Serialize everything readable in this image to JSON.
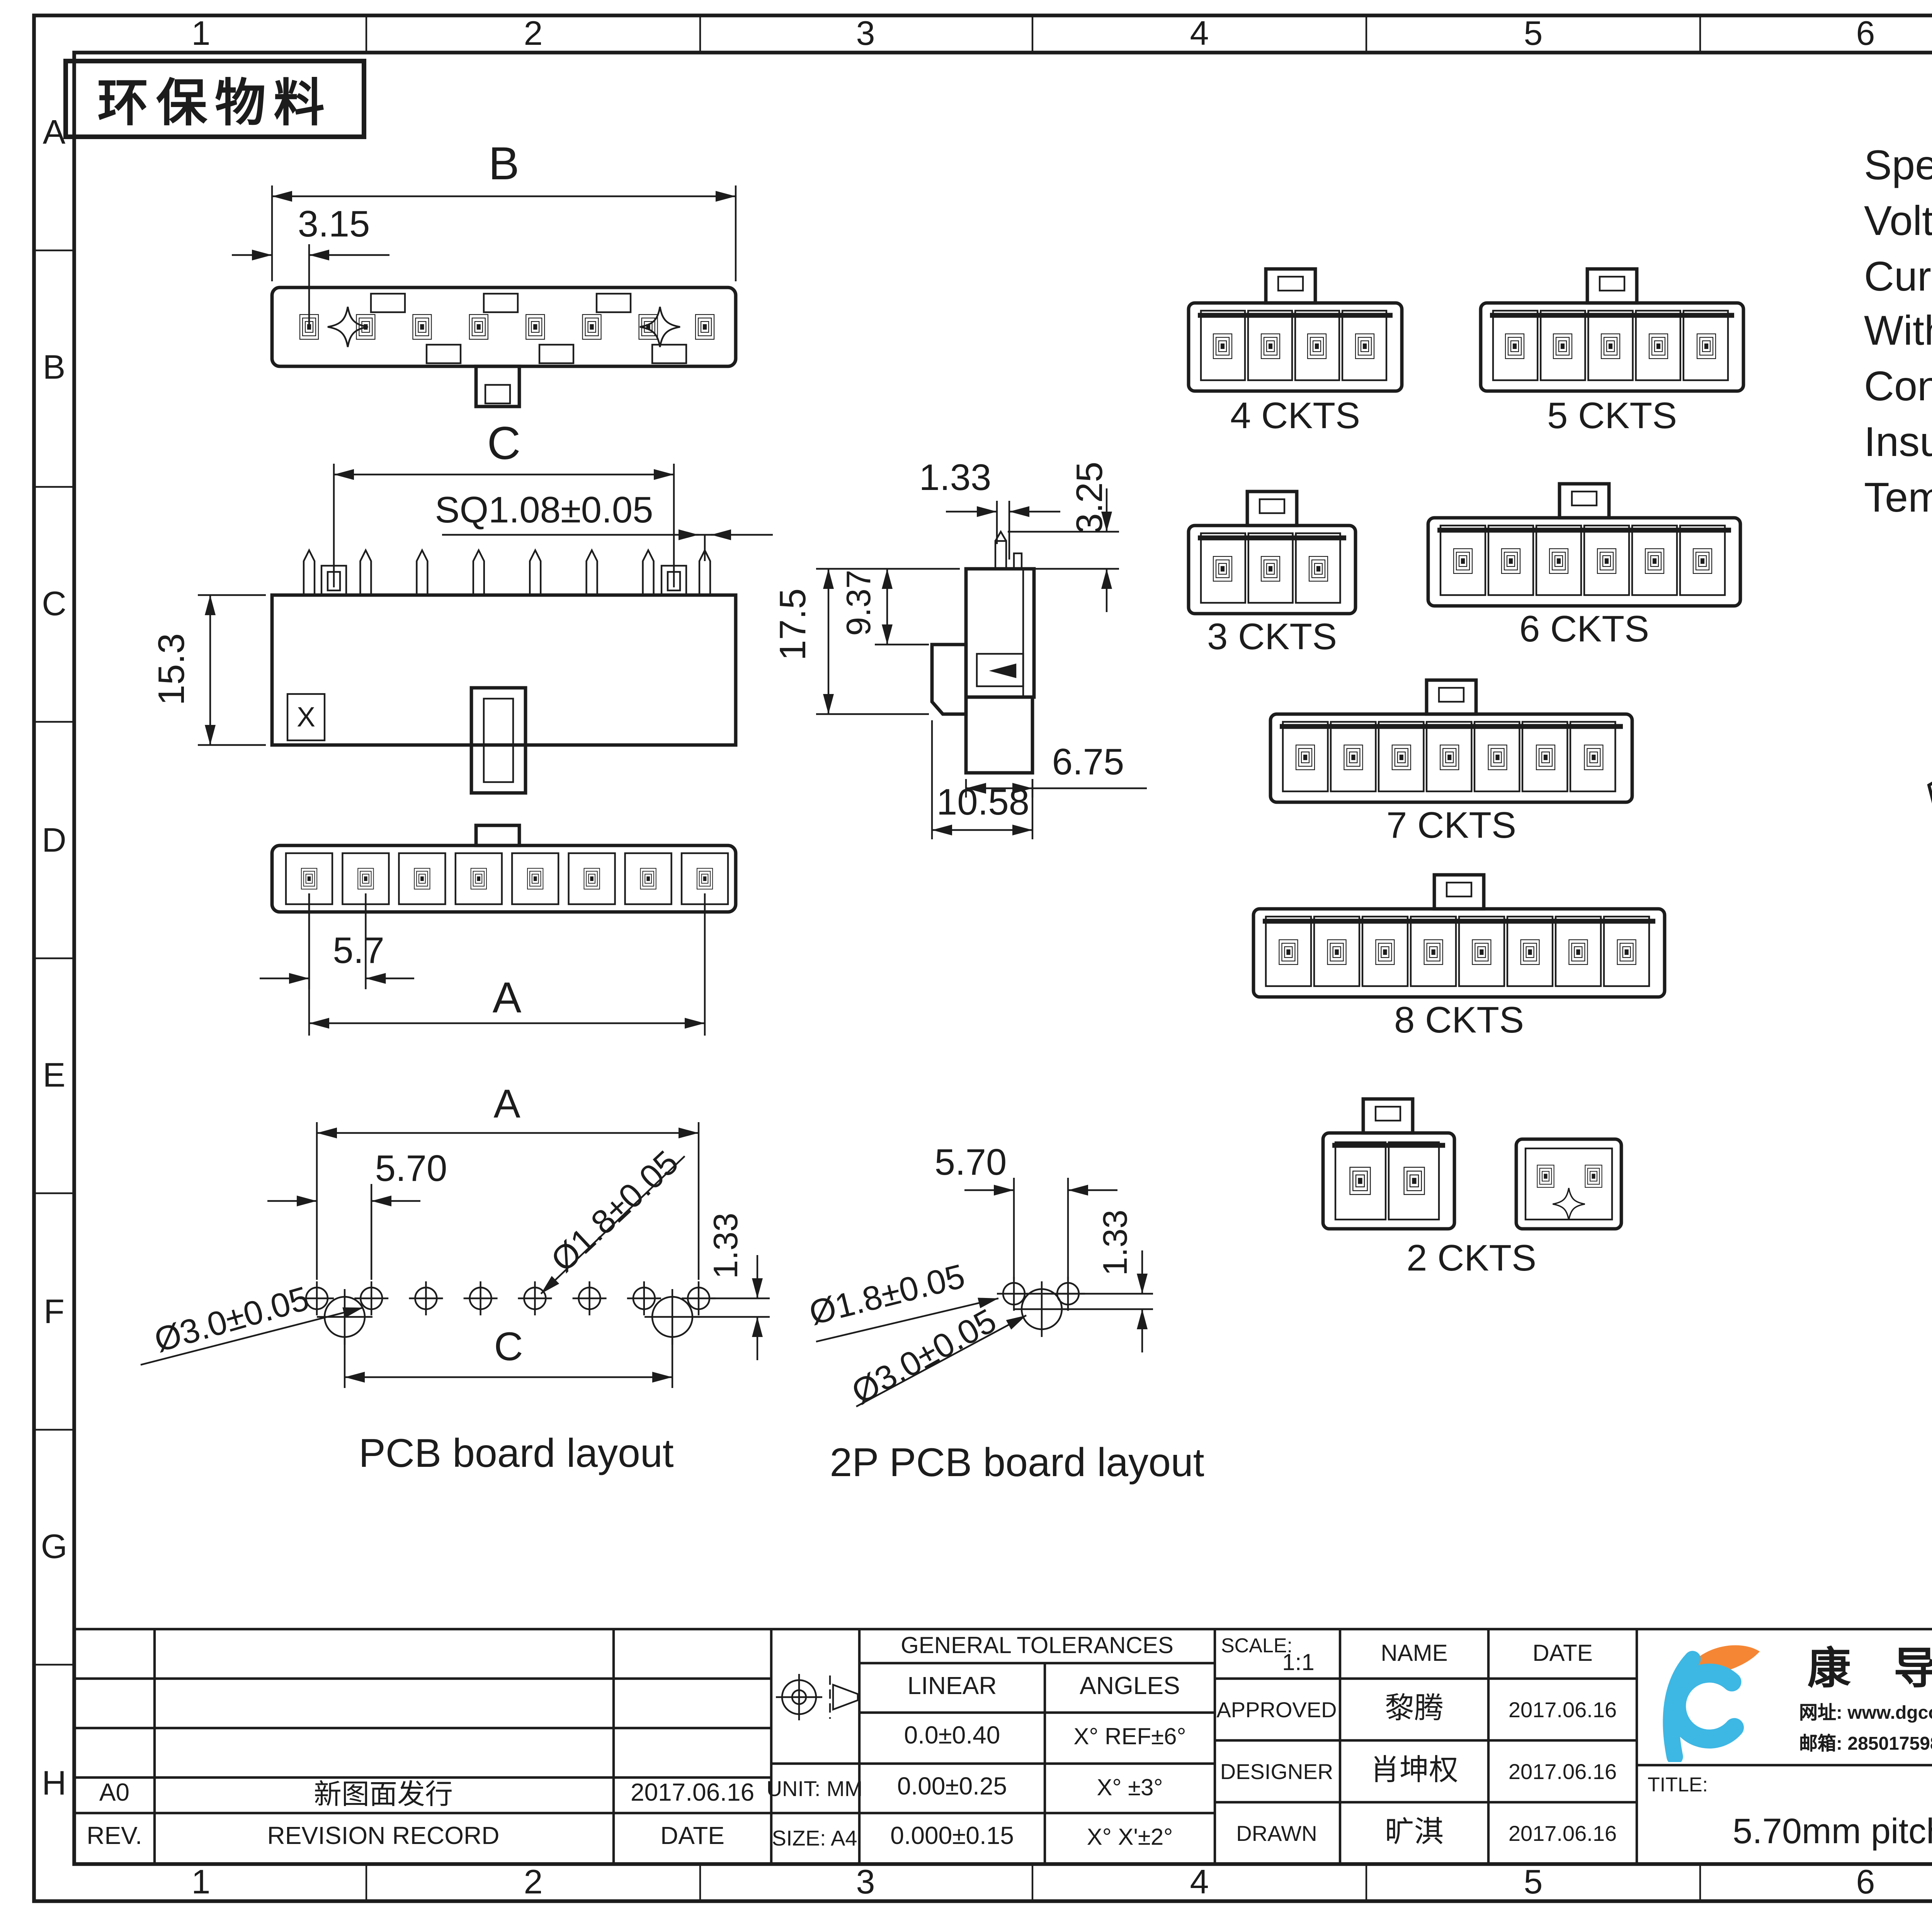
{
  "sheet": {
    "stamp": "环保物料",
    "zone_columns": [
      "1",
      "2",
      "3",
      "4",
      "5",
      "6",
      "7",
      "8"
    ],
    "zone_rows": [
      "A",
      "B",
      "C",
      "D",
      "E",
      "F",
      "G",
      "H"
    ]
  },
  "specs": {
    "title": "Specifications:",
    "lines": [
      "Voltage Rating : 600V AC/DC",
      "Current Rating : 10A AC,DC",
      "Withstand Voltage : 2200V AC/minute",
      "Contact Resistance : 10mΩ(MAX.)",
      "Insulation Resistance : 1000MΩ(MIN.)",
      "Temperature Range : -40°C~+105°C"
    ]
  },
  "dims": {
    "top_B": "B",
    "top_315": "3.15",
    "front_C": "C",
    "front_sq": "SQ1.08±0.05",
    "front_153": "15.3",
    "front_x": "X",
    "side_133": "1.33",
    "side_325": "3.25",
    "side_175": "17.5",
    "side_937": "9.37",
    "side_675": "6.75",
    "side_1058": "10.58",
    "bot_57": "5.7",
    "bot_A": "A",
    "pcb_A": "A",
    "pcb_570": "5.70",
    "pcb_d18": "Ø1.8±0.05",
    "pcb_d30": "Ø3.0±0.05",
    "pcb_133": "1.33",
    "pcb_C": "C",
    "pcb_caption": "PCB board layout",
    "p2_570": "5.70",
    "p2_133": "1.33",
    "p2_d18": "Ø1.8±0.05",
    "p2_d30": "Ø3.0±0.05",
    "p2_caption": "2P PCB board layout"
  },
  "variants": [
    {
      "label": "4 CKTS"
    },
    {
      "label": "5 CKTS"
    },
    {
      "label": "3 CKTS"
    },
    {
      "label": "6 CKTS"
    },
    {
      "label": "7 CKTS"
    },
    {
      "label": "8 CKTS"
    },
    {
      "label": "2 CKTS"
    }
  ],
  "dim_table": {
    "headers": [
      "Circuits",
      "DIM A",
      "DIM B",
      "DIM C"
    ],
    "rows": [
      [
        "2",
        "5.70",
        "12.00",
        ""
      ],
      [
        "3",
        "11.40",
        "17.70",
        "5.70"
      ],
      [
        "4",
        "17.10",
        "23.40",
        "11.40"
      ],
      [
        "5",
        "22.80",
        "29.10",
        "17.10"
      ],
      [
        "6",
        "28.50",
        "34.80",
        "22.80"
      ],
      [
        "7",
        "34.20",
        "40.50",
        "28.50"
      ],
      [
        "8",
        "39.90",
        "46.20",
        "34.20"
      ]
    ]
  },
  "materials": {
    "headers": [
      "Material",
      "Color",
      "PIN Material"
    ],
    "values": [
      "LCP,UL94V-0",
      "BLACK",
      "High conductivity copper/Tin&Ni-plated"
    ]
  },
  "title_block": {
    "revision": {
      "rev": "A0",
      "record": "新图面发行",
      "date": "2017.06.16",
      "headers": [
        "REV.",
        "REVISION RECORD",
        "DATE"
      ]
    },
    "unit": "UNIT: MM",
    "size": "SIZE: A4",
    "tol": {
      "title": "GENERAL TOLERANCES",
      "linear": "LINEAR",
      "angles": "ANGLES",
      "rows": [
        [
          "0.0±0.40",
          "X° REF±6°"
        ],
        [
          "0.00±0.25",
          "X° ±3°"
        ],
        [
          "0.000±0.15",
          "X° X'±2°"
        ]
      ]
    },
    "scale_label": "SCALE:",
    "scale": "1:1",
    "name_h": "NAME",
    "date_h": "DATE",
    "signers": [
      {
        "role": "APPROVED",
        "name": "黎腾",
        "date": "2017.06.16"
      },
      {
        "role": "DESIGNER",
        "name": "肖坤权",
        "date": "2017.06.16"
      },
      {
        "role": "DRAWN",
        "name": "旷淇",
        "date": "2017.06.16"
      }
    ],
    "company": "康 导 新 能 源",
    "contact": {
      "web_label": "网址:",
      "web": "www.dgconne.com",
      "tel_label": "电话:",
      "tel": "0769-853377633",
      "mail_label": "邮箱:",
      "mail": "2850175986@qq.com",
      "fax_label": "传真:",
      "fax": "0769-853922827"
    },
    "part_label": "PART.NO:",
    "part": "45702W00-NP*-A1-**",
    "dwg_label": "DWG.NO:",
    "dwg": "ENDE05",
    "title_label": "TITLE:",
    "title": "5.70mm pitch single",
    "title_em": "Wafer",
    "rev_label": "REV:",
    "rev": "A0",
    "sheet_label": "SHEET:",
    "sheet": "1/1"
  }
}
